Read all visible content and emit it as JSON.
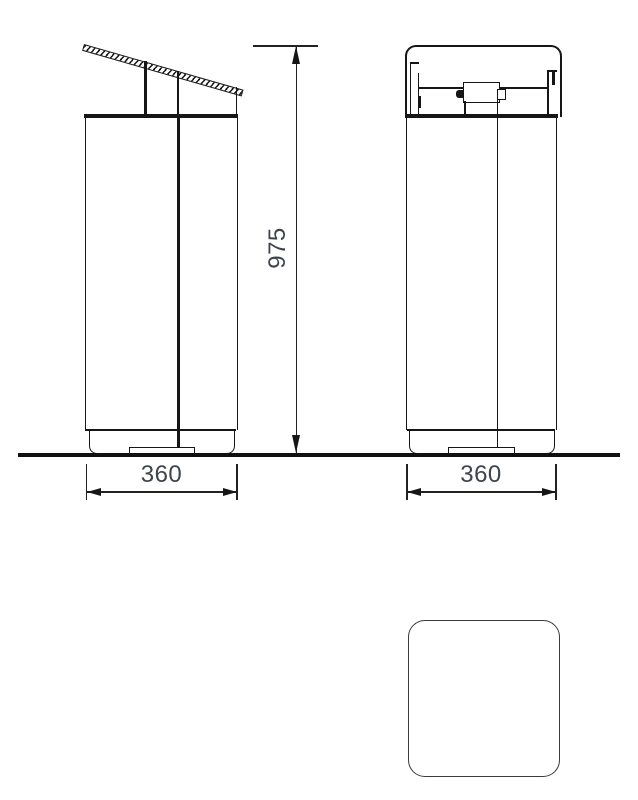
{
  "drawing": {
    "colors": {
      "line": "#161616",
      "ground": "#111111",
      "dim_text": "#3e444b",
      "top_view_outline": "#3a3a3a",
      "background": "#ffffff"
    },
    "dimensions": {
      "overall_height": "975",
      "side_width": "360",
      "front_width": "360"
    }
  }
}
